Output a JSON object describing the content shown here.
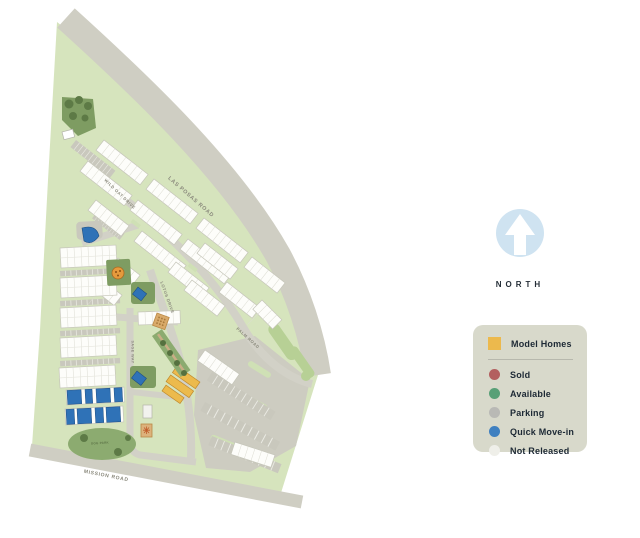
{
  "map": {
    "road_labels": {
      "las_posas": "LAS POSAS ROAD",
      "wild_oat": "WILD OAT DRIVE",
      "lotus": "LOTUS DRIVE",
      "palm": "PALM ROAD",
      "sage": "SAGE WAY",
      "mission": "MISSION ROAD"
    },
    "area_labels": {
      "dog_park": "DOG PARK"
    },
    "colors": {
      "site_green": "#d6e4bd",
      "road_gray": "#cfcec3",
      "building_white": "#fdfdfa"
    }
  },
  "north": {
    "label": "NORTH"
  },
  "legend": {
    "model": {
      "label": "Model Homes",
      "color": "#ecb94d"
    },
    "items": [
      {
        "label": "Sold",
        "color": "#b35f5f"
      },
      {
        "label": "Available",
        "color": "#58a077"
      },
      {
        "label": "Parking",
        "color": "#b9b9b5"
      },
      {
        "label": "Quick Move-in",
        "color": "#3f80c0"
      },
      {
        "label": "Not Released",
        "color": "#efefe9"
      }
    ]
  }
}
